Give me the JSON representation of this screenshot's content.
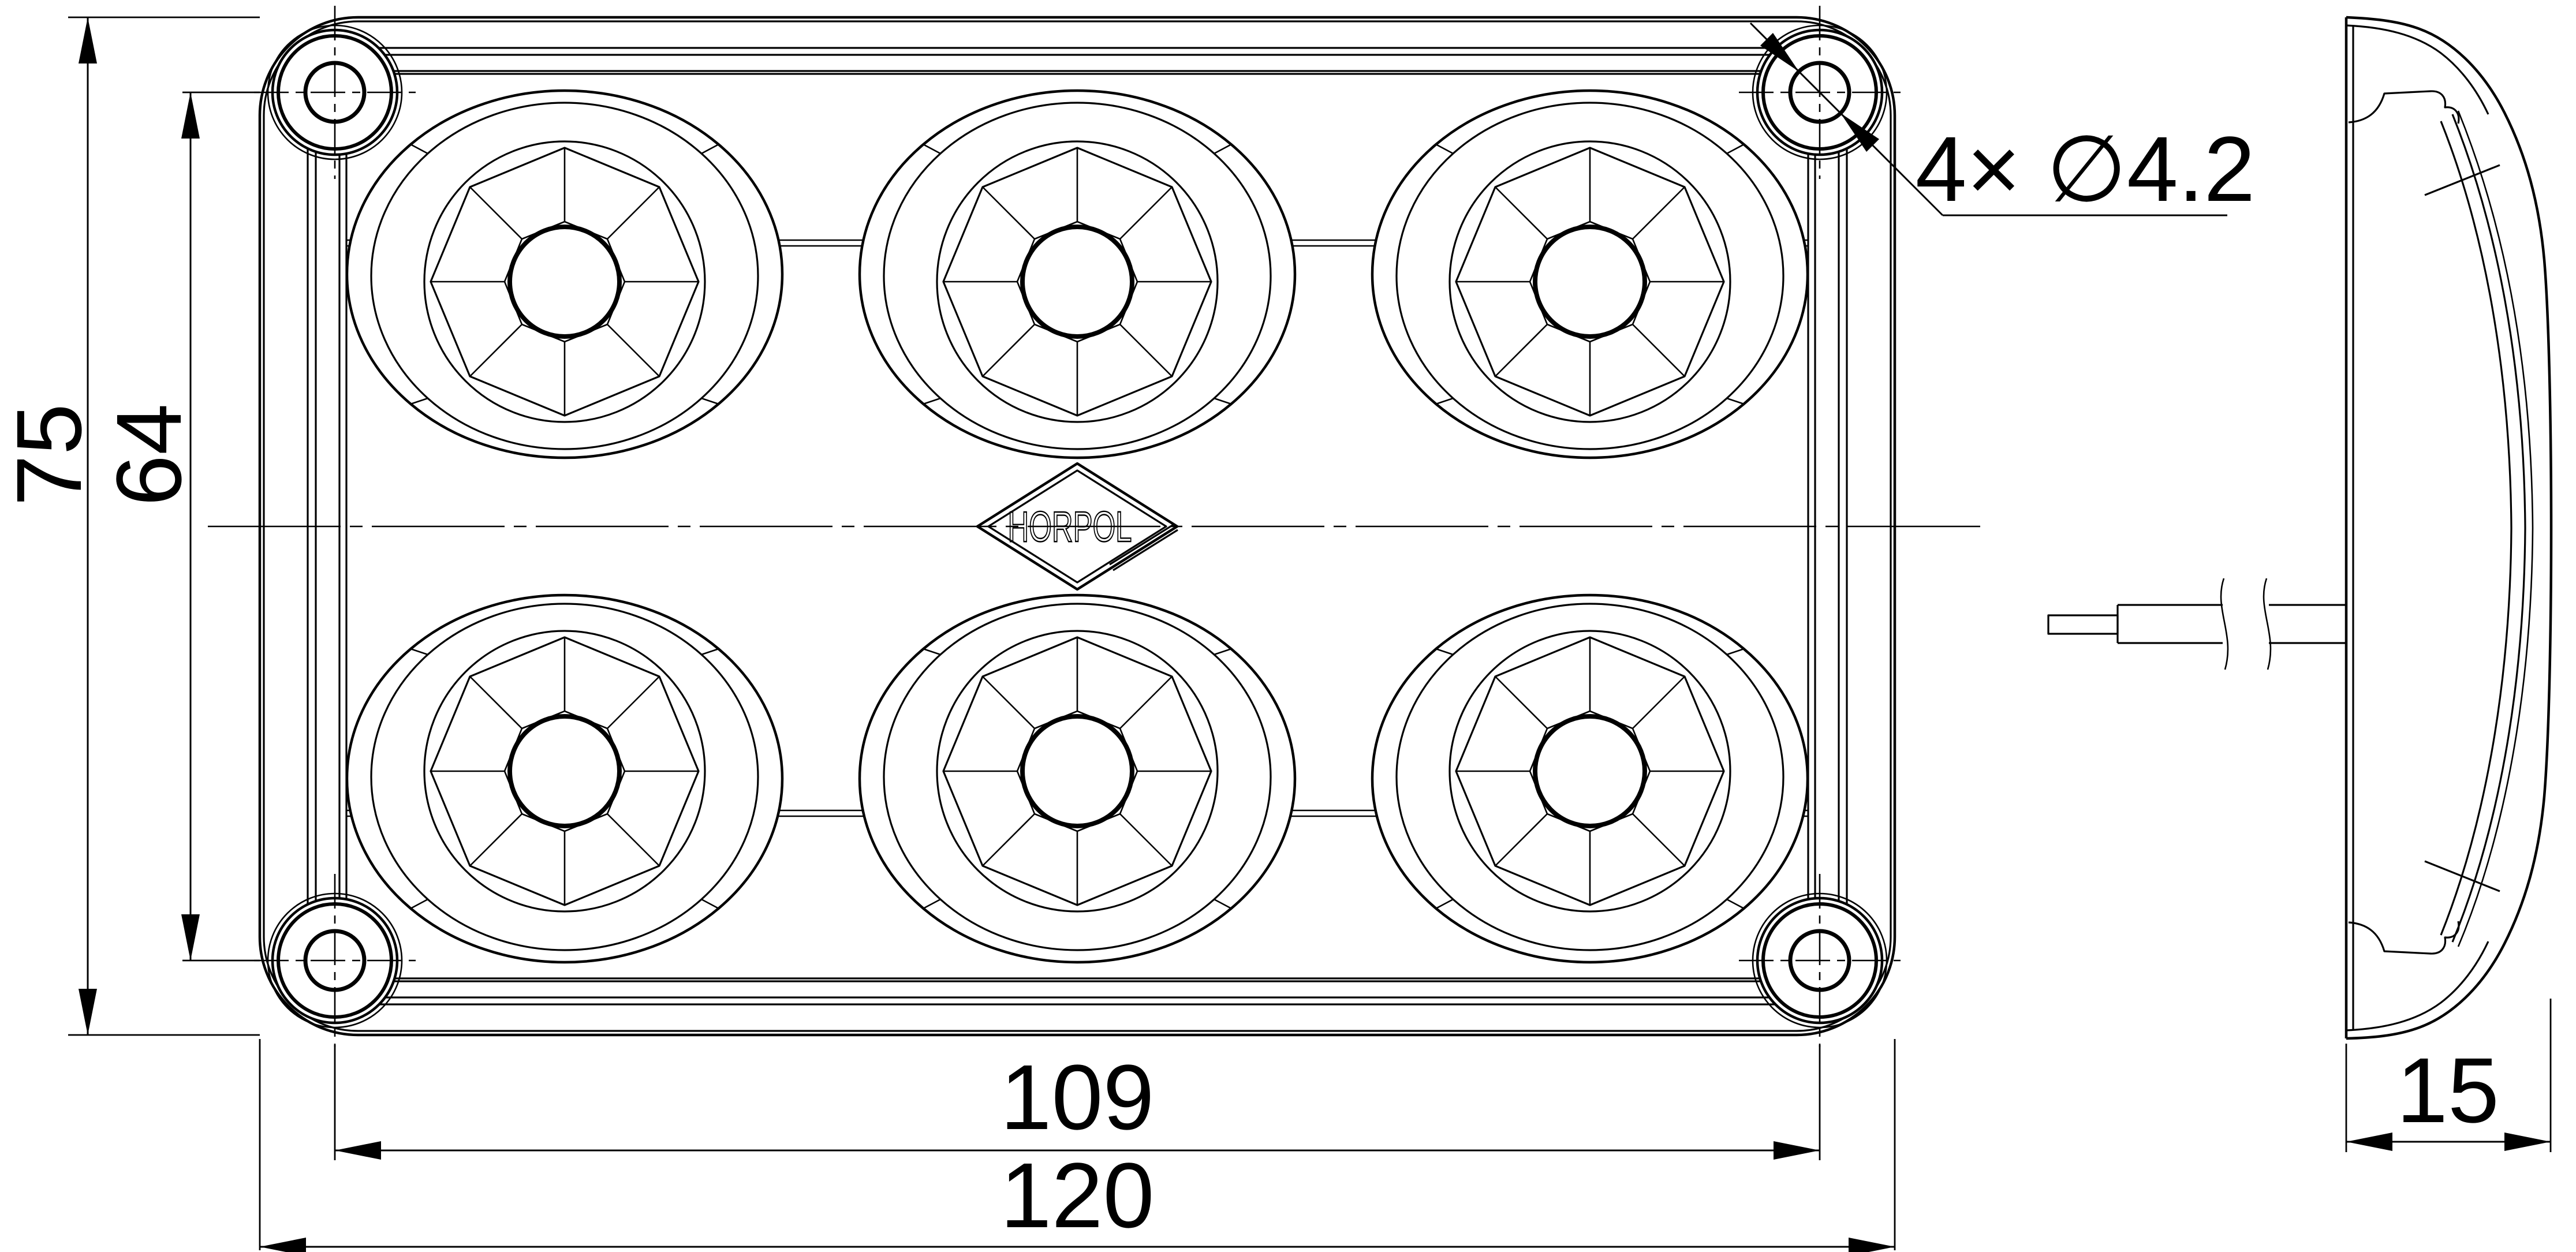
{
  "dimensions": {
    "overall_height": "75",
    "hole_spacing_vertical": "64",
    "hole_spacing_horizontal": "109",
    "overall_width": "120",
    "depth": "15",
    "mounting_holes_callout": "4× ∅4.2"
  },
  "logo": {
    "text": "HORPOL"
  },
  "colors": {
    "line": "#000000",
    "background": "#ffffff"
  }
}
